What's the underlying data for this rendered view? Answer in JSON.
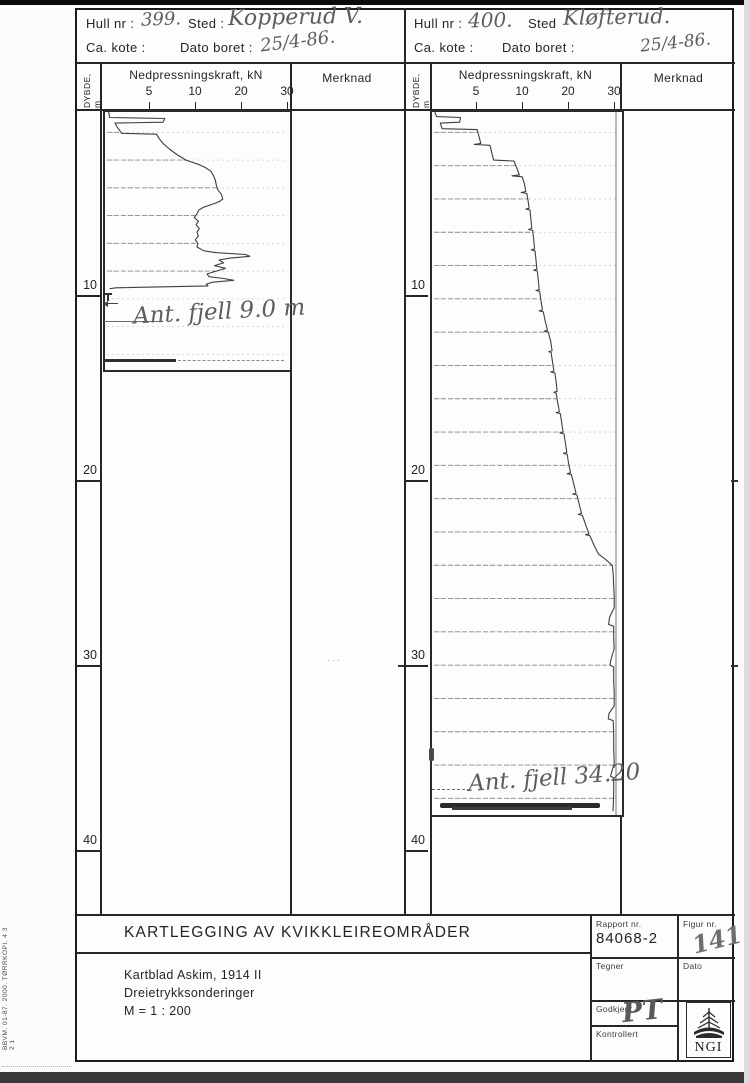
{
  "edge_text": "BBVM. 01-87. 2000. TØRRKOPI. 4 3 2 1",
  "boreholes": [
    {
      "hull_label": "Hull nr :",
      "hull_value": "399.",
      "sted_label": "Sted :",
      "sted_value": "Kopperud V.",
      "kote_label": "Ca. kote :",
      "dato_label": "Dato boret :",
      "dato_value": "25/4-86.",
      "depth_axis_label": "DYBDE, m",
      "force_axis_label": "Nedpressningskraft, kN",
      "merknad_label": "Merknad",
      "annotation": "Ant. fjell 9.0 m",
      "merknad_note": "···"
    },
    {
      "hull_label": "Hull nr :",
      "hull_value": "400.",
      "sted_label": "Sted",
      "sted_value": "Kløfterud.",
      "kote_label": "Ca. kote :",
      "dato_label": "Dato boret :",
      "dato_value": "25/4-86.",
      "depth_axis_label": "DYBDE, m",
      "force_axis_label": "Nedpressningskraft, kN",
      "merknad_label": "Merknad",
      "annotation": "Ant. fjell 34.20"
    }
  ],
  "title_block": {
    "title": "KARTLEGGING AV KVIKKLEIREOMRÅDER",
    "line1": "Kartblad Askim, 1914 II",
    "line2": "Dreietrykksonderinger",
    "line3": "M = 1 : 200",
    "rapport_label": "Rapport nr.",
    "rapport_value": "84068-2",
    "figur_label": "Figur nr.",
    "figur_value": "141",
    "tegner_label": "Tegner",
    "dato_label": "Dato",
    "godkjent_label": "Godkjent",
    "godkjent_value": "PT",
    "kontrollert_label": "Kontrollert",
    "logo_text": "NGI"
  },
  "chart_data": [
    {
      "type": "line",
      "title": "Hull nr 399 – Kopperud V. – dreietrykksondering",
      "xlabel": "Nedpressningskraft, kN",
      "ylabel": "DYBDE, m",
      "x_ticks": [
        5,
        10,
        20,
        30
      ],
      "x_scale_note": "non-linear axis: 0-10 kN plotted at twice the spacing of 10-30 kN",
      "depth_ticks": [
        10,
        20,
        30,
        40
      ],
      "depth_range_m": [
        0,
        13.9
      ],
      "bedrock_depth_m": 9.0,
      "termination_depth_m": 9.5,
      "points": [
        [
          0.0,
          0.4
        ],
        [
          0.3,
          0.5
        ],
        [
          0.35,
          6.5
        ],
        [
          0.55,
          6.3
        ],
        [
          0.6,
          1.1
        ],
        [
          0.8,
          1.3
        ],
        [
          1.0,
          1.6
        ],
        [
          1.15,
          1.8
        ],
        [
          1.2,
          5.6
        ],
        [
          1.45,
          5.9
        ],
        [
          1.7,
          6.3
        ],
        [
          2.0,
          7.0
        ],
        [
          2.3,
          7.8
        ],
        [
          2.6,
          8.8
        ],
        [
          2.85,
          10.5
        ],
        [
          3.0,
          11.8
        ],
        [
          3.2,
          13.0
        ],
        [
          3.45,
          13.6
        ],
        [
          3.7,
          14.0
        ],
        [
          3.95,
          14.2
        ],
        [
          4.2,
          14.5
        ],
        [
          4.45,
          15.3
        ],
        [
          4.7,
          15.6
        ],
        [
          4.85,
          14.8
        ],
        [
          5.0,
          13.2
        ],
        [
          5.15,
          11.4
        ],
        [
          5.3,
          10.4
        ],
        [
          5.5,
          10.0
        ],
        [
          5.7,
          9.7
        ],
        [
          5.9,
          10.3
        ],
        [
          6.1,
          9.9
        ],
        [
          6.3,
          10.5
        ],
        [
          6.5,
          10.0
        ],
        [
          6.7,
          10.3
        ],
        [
          6.9,
          9.8
        ],
        [
          7.1,
          10.2
        ],
        [
          7.3,
          10.0
        ],
        [
          7.5,
          11.5
        ],
        [
          7.6,
          14.0
        ],
        [
          7.7,
          20.5
        ],
        [
          7.8,
          21.5
        ],
        [
          7.9,
          17.0
        ],
        [
          8.0,
          14.8
        ],
        [
          8.15,
          15.8
        ],
        [
          8.3,
          13.8
        ],
        [
          8.45,
          16.2
        ],
        [
          8.6,
          14.2
        ],
        [
          8.75,
          12.2
        ],
        [
          8.9,
          12.6
        ],
        [
          9.0,
          15.8
        ],
        [
          9.1,
          18.0
        ],
        [
          9.2,
          13.4
        ],
        [
          9.3,
          12.0
        ],
        [
          9.4,
          12.4
        ],
        [
          9.5,
          1.2
        ],
        [
          9.55,
          0.5
        ]
      ]
    },
    {
      "type": "line",
      "title": "Hull nr 400 – Kløfterud – dreietrykksondering",
      "xlabel": "Nedpressningskraft, kN",
      "ylabel": "DYBDE, m",
      "x_ticks": [
        5,
        10,
        20,
        30
      ],
      "x_scale_note": "non-linear axis: 0-10 kN plotted at twice the spacing of 10-30 kN",
      "depth_ticks": [
        10,
        20,
        30,
        40
      ],
      "depth_range_m": [
        0,
        38
      ],
      "bedrock_depth_m": 34.2,
      "termination_depth_m": 37.8,
      "grid_x": [
        30
      ],
      "points": [
        [
          0.0,
          0.3
        ],
        [
          0.25,
          0.5
        ],
        [
          0.3,
          3.1
        ],
        [
          0.55,
          3.0
        ],
        [
          0.6,
          0.9
        ],
        [
          0.9,
          1.1
        ],
        [
          0.95,
          4.9
        ],
        [
          1.3,
          5.1
        ],
        [
          1.7,
          5.3
        ],
        [
          1.75,
          4.6
        ],
        [
          1.8,
          6.3
        ],
        [
          2.2,
          6.5
        ],
        [
          2.6,
          6.7
        ],
        [
          2.65,
          8.9
        ],
        [
          3.0,
          9.2
        ],
        [
          3.4,
          9.5
        ],
        [
          3.45,
          8.7
        ],
        [
          3.5,
          9.8
        ],
        [
          3.9,
          10.1
        ],
        [
          4.3,
          10.4
        ],
        [
          4.35,
          9.7
        ],
        [
          4.4,
          10.6
        ],
        [
          4.8,
          10.9
        ],
        [
          5.2,
          11.1
        ],
        [
          5.25,
          10.4
        ],
        [
          5.3,
          11.3
        ],
        [
          5.8,
          11.5
        ],
        [
          6.3,
          11.7
        ],
        [
          6.35,
          11.0
        ],
        [
          6.4,
          11.9
        ],
        [
          6.9,
          12.1
        ],
        [
          7.4,
          12.3
        ],
        [
          7.45,
          11.6
        ],
        [
          7.5,
          12.4
        ],
        [
          8.0,
          12.6
        ],
        [
          8.5,
          12.8
        ],
        [
          8.55,
          12.1
        ],
        [
          8.6,
          12.9
        ],
        [
          9.1,
          13.1
        ],
        [
          9.6,
          13.3
        ],
        [
          9.65,
          12.6
        ],
        [
          9.7,
          13.4
        ],
        [
          10.2,
          13.7
        ],
        [
          10.7,
          14.0
        ],
        [
          10.75,
          13.3
        ],
        [
          10.8,
          14.2
        ],
        [
          11.3,
          14.6
        ],
        [
          11.8,
          15.1
        ],
        [
          11.85,
          14.4
        ],
        [
          11.9,
          15.3
        ],
        [
          12.4,
          15.8
        ],
        [
          12.9,
          16.1
        ],
        [
          12.95,
          15.4
        ],
        [
          13.0,
          15.9
        ],
        [
          13.5,
          16.2
        ],
        [
          14.0,
          16.5
        ],
        [
          14.05,
          15.8
        ],
        [
          14.1,
          16.7
        ],
        [
          14.6,
          17.0
        ],
        [
          15.1,
          17.2
        ],
        [
          15.15,
          16.5
        ],
        [
          15.2,
          17.0
        ],
        [
          15.7,
          17.3
        ],
        [
          16.2,
          17.7
        ],
        [
          16.25,
          17.0
        ],
        [
          16.3,
          17.9
        ],
        [
          16.8,
          18.2
        ],
        [
          17.3,
          18.5
        ],
        [
          17.35,
          17.8
        ],
        [
          17.4,
          18.7
        ],
        [
          17.9,
          19.0
        ],
        [
          18.4,
          19.3
        ],
        [
          18.45,
          18.6
        ],
        [
          18.5,
          19.4
        ],
        [
          19.0,
          19.7
        ],
        [
          19.5,
          20.1
        ],
        [
          19.55,
          19.4
        ],
        [
          19.6,
          20.3
        ],
        [
          20.1,
          20.8
        ],
        [
          20.6,
          21.3
        ],
        [
          20.65,
          20.6
        ],
        [
          20.7,
          21.5
        ],
        [
          21.2,
          22.0
        ],
        [
          21.7,
          22.5
        ],
        [
          21.75,
          21.8
        ],
        [
          21.8,
          22.7
        ],
        [
          22.3,
          23.4
        ],
        [
          22.8,
          24.1
        ],
        [
          22.85,
          23.4
        ],
        [
          22.9,
          24.3
        ],
        [
          23.4,
          25.2
        ],
        [
          23.9,
          26.2
        ],
        [
          24.2,
          27.8
        ],
        [
          24.5,
          29.2
        ],
        [
          25.0,
          29.4
        ],
        [
          25.6,
          29.5
        ],
        [
          26.2,
          29.6
        ],
        [
          26.8,
          29.6
        ],
        [
          27.3,
          28.6
        ],
        [
          27.7,
          28.4
        ],
        [
          27.8,
          29.5
        ],
        [
          28.4,
          29.5
        ],
        [
          29.0,
          29.6
        ],
        [
          29.6,
          28.9
        ],
        [
          29.9,
          28.7
        ],
        [
          30.0,
          29.5
        ],
        [
          30.7,
          29.5
        ],
        [
          31.4,
          29.6
        ],
        [
          32.1,
          29.6
        ],
        [
          32.5,
          28.5
        ],
        [
          32.8,
          28.3
        ],
        [
          32.9,
          29.4
        ],
        [
          33.6,
          29.5
        ],
        [
          34.4,
          29.5
        ],
        [
          35.2,
          29.6
        ],
        [
          35.9,
          28.8
        ],
        [
          36.0,
          29.5
        ],
        [
          36.8,
          29.5
        ],
        [
          37.6,
          29.4
        ],
        [
          37.8,
          29.3
        ]
      ]
    }
  ]
}
